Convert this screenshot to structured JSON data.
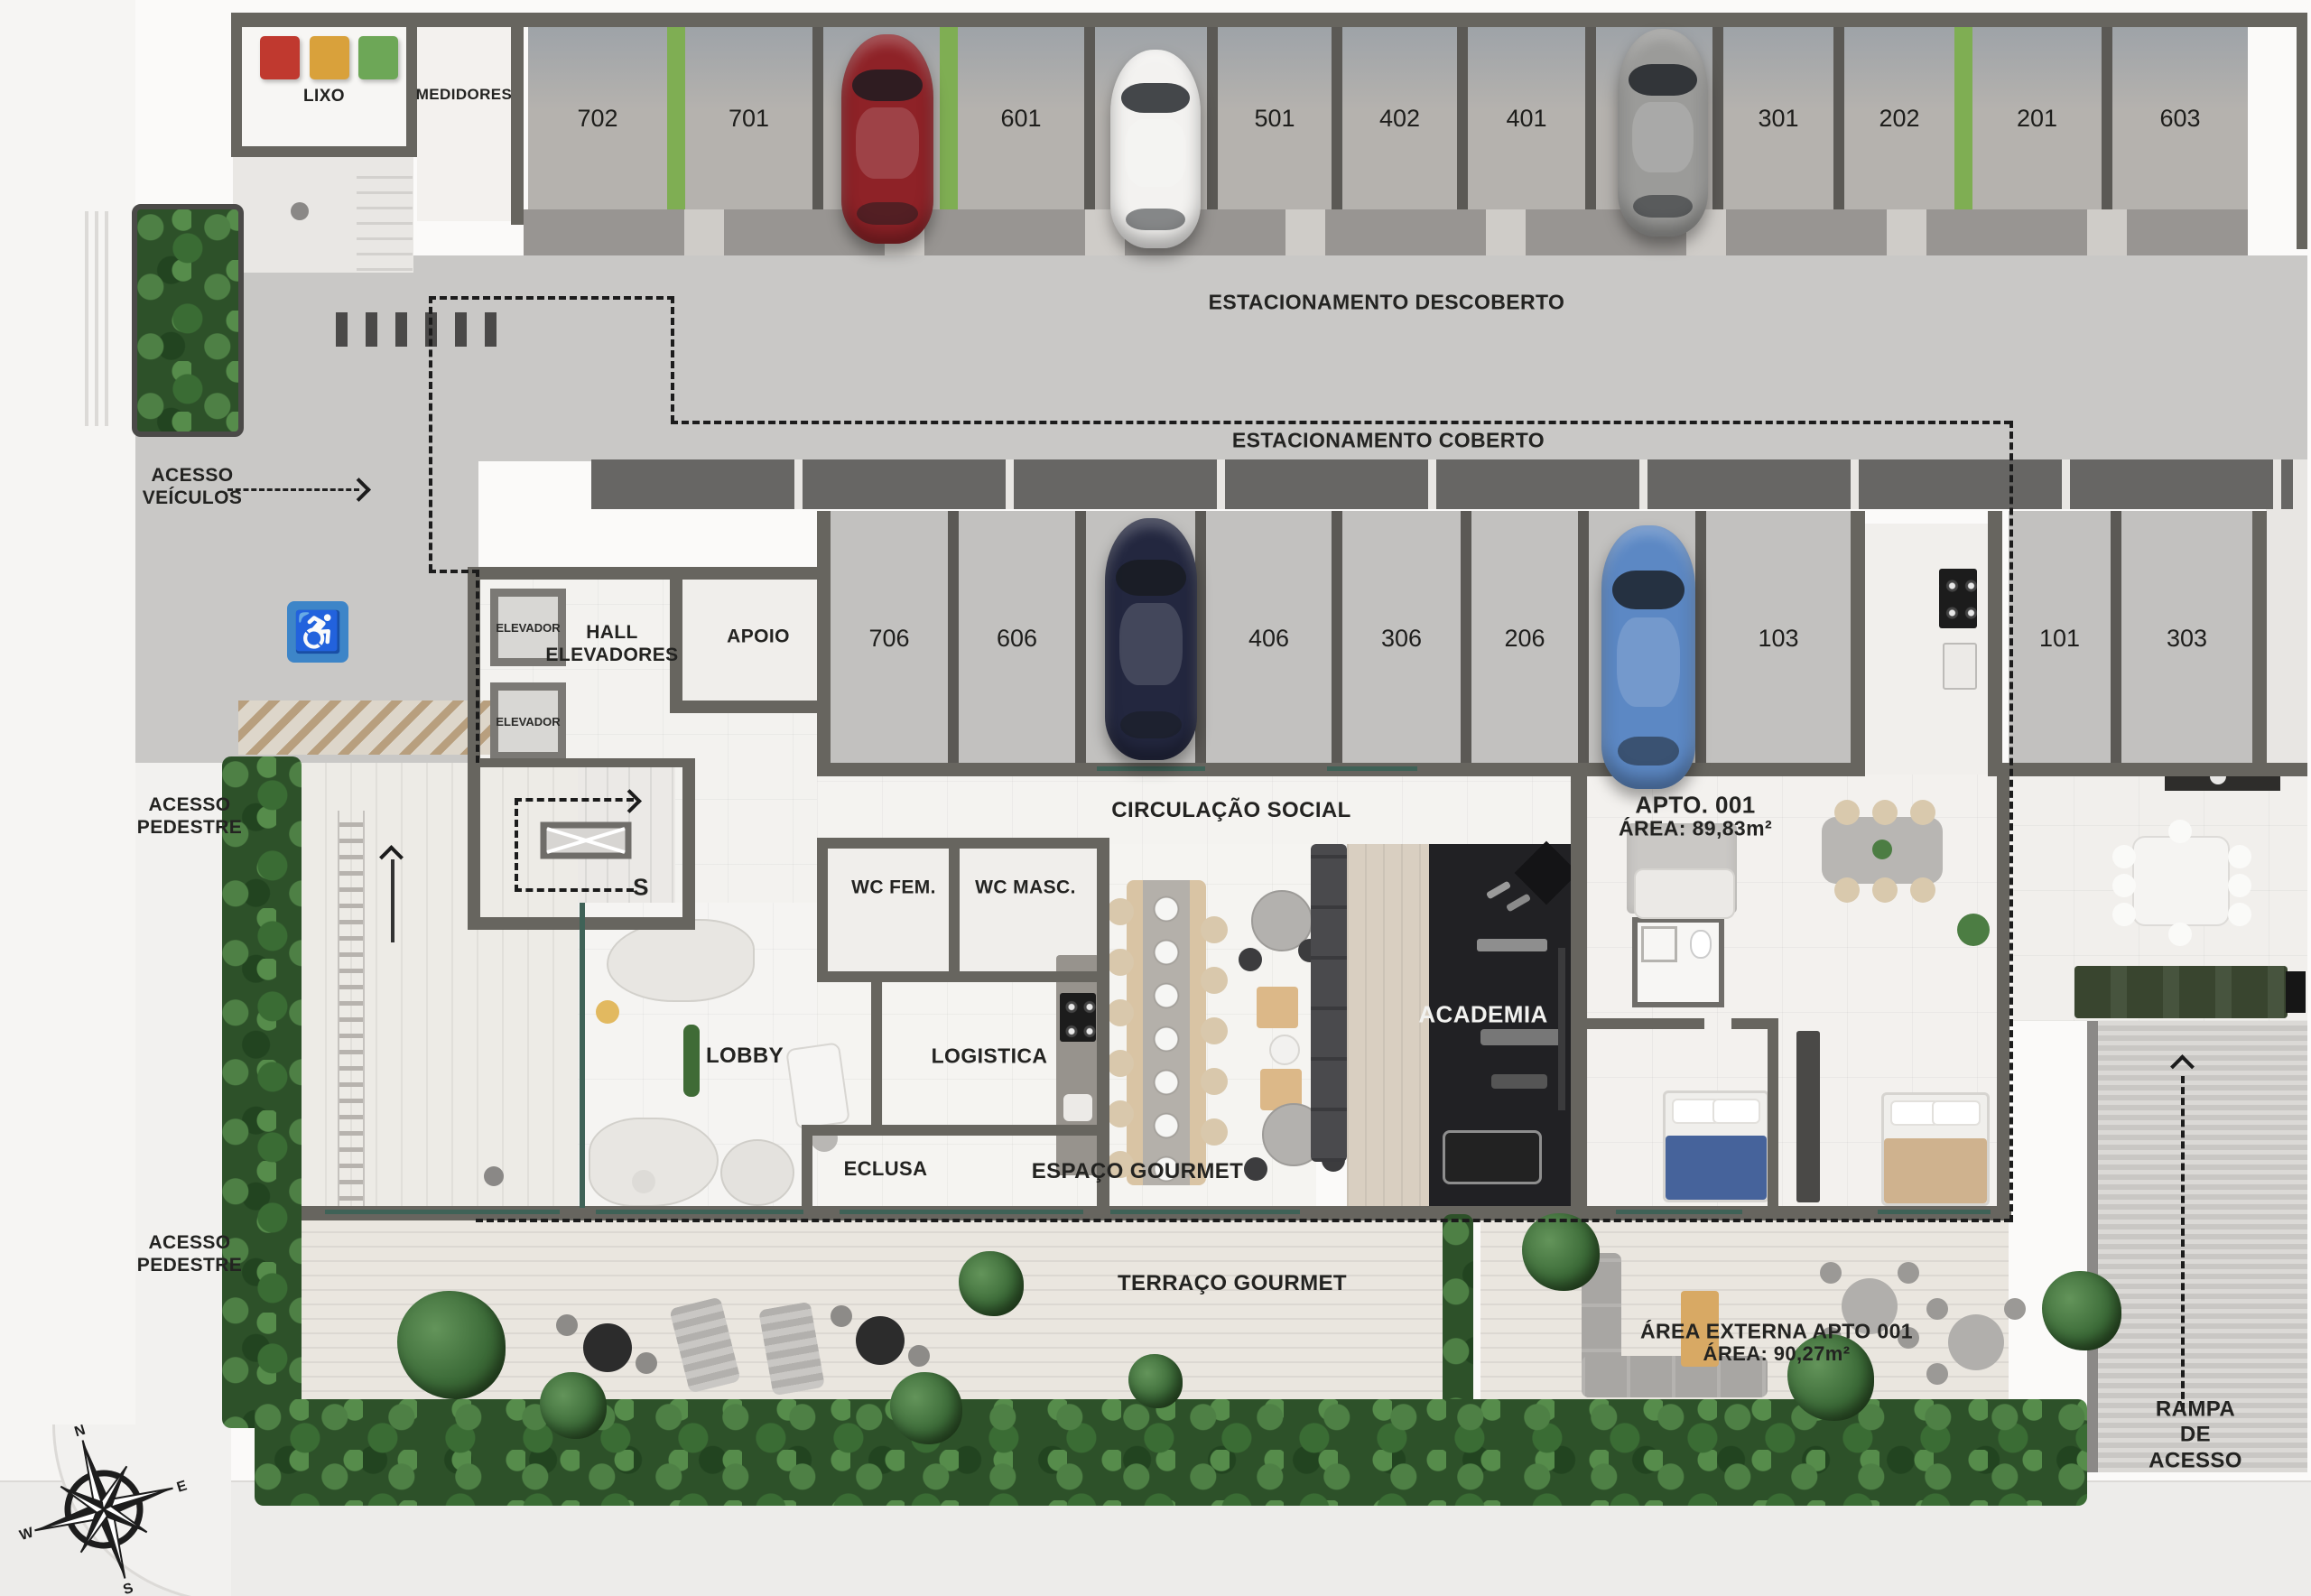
{
  "colors": {
    "accent_green": "#7fae53",
    "handicap_blue": "#3d85c8",
    "glass_teal": "#3f6257",
    "academia_floor": "#212124",
    "car_red": "#8e2227",
    "car_white": "#f3f2f0",
    "car_silver": "#9b9b99",
    "car_navy": "#23273f",
    "car_blue": "#5c88c4"
  },
  "parking": {
    "uncovered": {
      "label": "ESTACIONAMENTO DESCOBERTO",
      "spaces": [
        {
          "num": "702"
        },
        {
          "num": "701"
        },
        {
          "num": "602",
          "car": "red"
        },
        {
          "num": "601"
        },
        {
          "num": "502",
          "car": "white"
        },
        {
          "num": "501"
        },
        {
          "num": "402"
        },
        {
          "num": "401"
        },
        {
          "num": "302",
          "car": "silver"
        },
        {
          "num": "301"
        },
        {
          "num": "202"
        },
        {
          "num": "201"
        },
        {
          "num": "603"
        }
      ]
    },
    "covered": {
      "label": "ESTACIONAMENTO COBERTO",
      "spaces": [
        {
          "num": "706"
        },
        {
          "num": "606"
        },
        {
          "num": "506",
          "car": "navy"
        },
        {
          "num": "406"
        },
        {
          "num": "306"
        },
        {
          "num": "206"
        },
        {
          "num": "106",
          "car": "blue"
        },
        {
          "num": "103"
        },
        {
          "num": "101"
        },
        {
          "num": "303"
        }
      ]
    }
  },
  "rooms": {
    "lixo": "LIXO",
    "medidores": "MEDIDORES",
    "elevador": "ELEVADOR",
    "hall_elevadores": "HALL\nELEVADORES",
    "apoio": "APOIO",
    "circulacao_social": "CIRCULAÇÃO SOCIAL",
    "wc_fem": "WC FEM.",
    "wc_masc": "WC MASC.",
    "lobby": "LOBBY",
    "logistica": "LOGISTICA",
    "eclusa": "ECLUSA",
    "espaco_gourmet": "ESPAÇO GOURMET",
    "academia": "ACADEMIA",
    "stair_mark": "S"
  },
  "apartment": {
    "name": "APTO. 001",
    "area": "ÁREA: 89,83m²",
    "external_name": "ÁREA EXTERNA APTO 001",
    "external_area": "ÁREA: 90,27m²"
  },
  "outdoor": {
    "terraco_gourmet": "TERRAÇO GOURMET",
    "rampa_acesso": "RAMPA DE\nACESSO"
  },
  "access": {
    "veiculos": "ACESSO\nVEÍCULOS",
    "pedestre_1": "ACESSO\nPEDESTRE",
    "pedestre_2": "ACESSO\nPEDESTRE"
  },
  "compass": {
    "n": "N",
    "e": "E",
    "s": "S",
    "w": "W"
  }
}
